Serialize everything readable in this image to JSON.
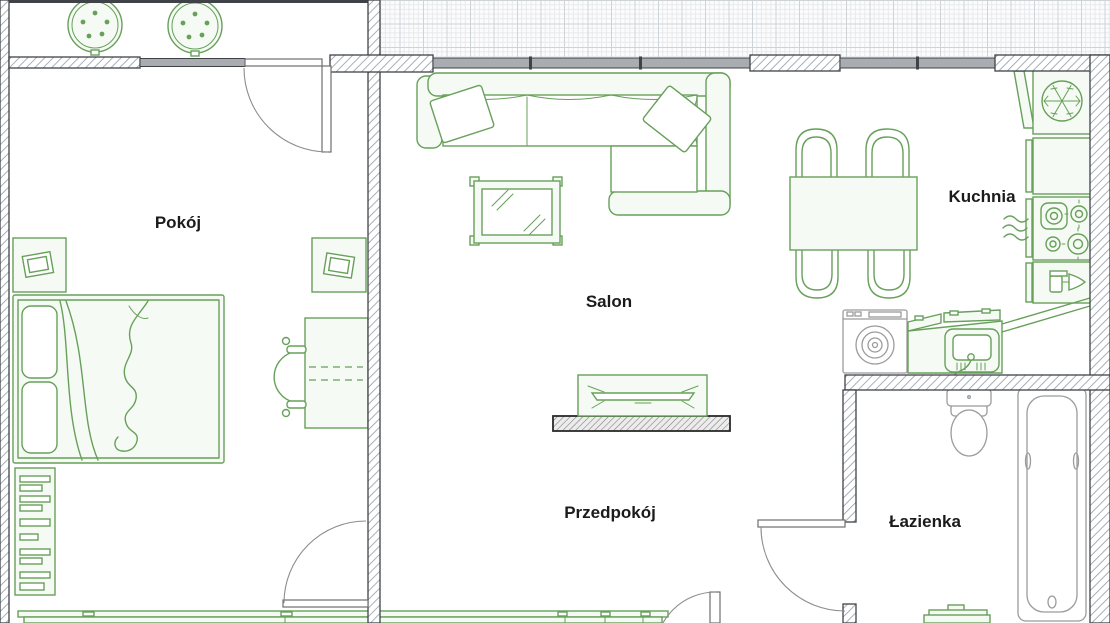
{
  "rooms": [
    {
      "id": "pokoj",
      "label": "Pokój"
    },
    {
      "id": "salon",
      "label": "Salon"
    },
    {
      "id": "kuchnia",
      "label": "Kuchnia"
    },
    {
      "id": "przedpokoj",
      "label": "Przedpokój"
    },
    {
      "id": "lazienka",
      "label": "Łazienka"
    }
  ],
  "colors": {
    "furniture_green": "#67a05a",
    "furniture_green_fill": "#f6faf4",
    "fixture_gray": "#9b9b9b",
    "wall": "#3f4347",
    "window_fill": "#a9adb1",
    "label_text": "#1b1b1b"
  },
  "icons": [
    "snowflake-freezer-icon",
    "stove-burners-icon",
    "dishwasher-glass-fork-icon",
    "washing-machine-drum-icon",
    "kitchen-sink-faucet-icon",
    "steam-vent-icon",
    "tv-icon",
    "mirror-table-icon",
    "toilet-icon",
    "bathtub-icon",
    "plant-table-icon"
  ]
}
